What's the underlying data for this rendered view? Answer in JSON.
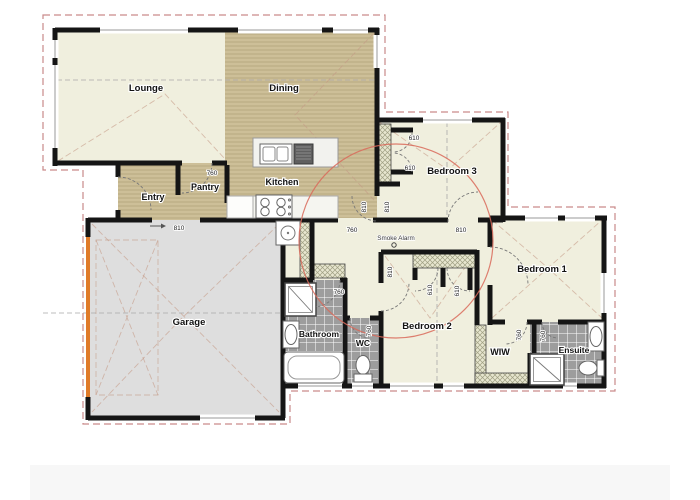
{
  "plan": {
    "rooms": {
      "lounge": "Lounge",
      "dining": "Dining",
      "entry": "Entry",
      "pantry": "Pantry",
      "kitchen": "Kitchen",
      "bedroom3": "Bedroom 3",
      "garage": "Garage",
      "bathroom": "Bathroom",
      "wc": "WC",
      "bedroom2": "Bedroom 2",
      "bedroom1": "Bedroom 1",
      "wiw": "WIW",
      "ensuite": "Ensuite"
    },
    "annotations": {
      "smoke_alarm": "Smoke Alarm"
    },
    "dims": [
      {
        "v": "760"
      },
      {
        "v": "810"
      },
      {
        "v": "810"
      },
      {
        "v": "810"
      },
      {
        "v": "610"
      },
      {
        "v": "610"
      },
      {
        "v": "810"
      },
      {
        "v": "760"
      },
      {
        "v": "810"
      },
      {
        "v": "610"
      },
      {
        "v": "610"
      },
      {
        "v": "760"
      },
      {
        "v": "760"
      },
      {
        "v": "760"
      },
      {
        "v": "760"
      }
    ],
    "colors": {
      "floor_cream": "#f0efde",
      "floor_timber": "#cdbf98",
      "garage_floor": "#dedede",
      "tile": "#9d9d9d",
      "wall": "#151515",
      "roof_dash": "#c98a8a",
      "alarm_circle": "#d96a5a",
      "garage_door": "#e07b28"
    }
  }
}
